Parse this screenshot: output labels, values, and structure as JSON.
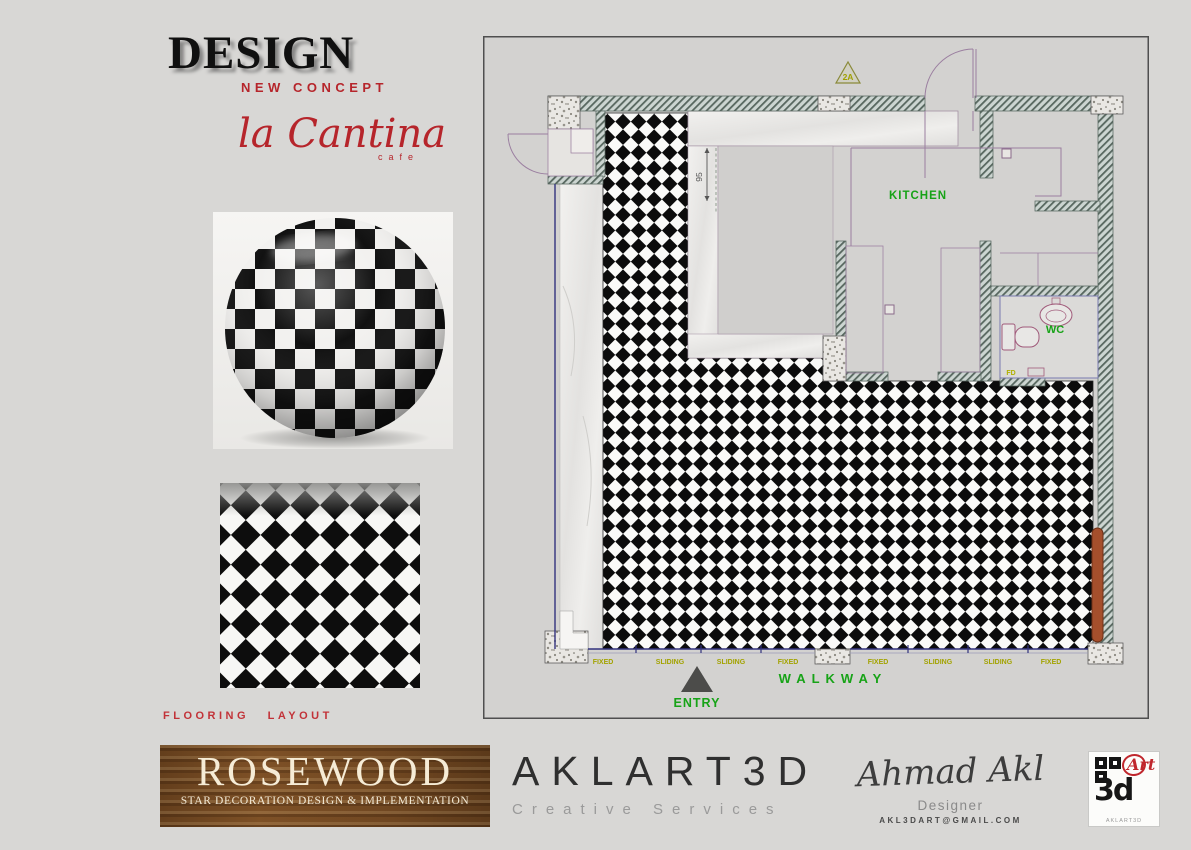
{
  "header": {
    "design_title": "DESIGN",
    "design_subtitle": "NEW CONCEPT",
    "cafe_script": "la Cantina",
    "cafe_word": "cafe"
  },
  "sidebar": {
    "flooring_label": "FLOORING LAYOUT"
  },
  "plan": {
    "kitchen_label": "KITCHEN",
    "wc_label": "WC",
    "floor_drain_label": "FD",
    "walkway_label": "WALKWAY",
    "entry_label": "ENTRY",
    "section_marker": "2A",
    "dimension_95": "95",
    "window_labels": [
      "FIXED",
      "SLIDING",
      "SLIDING",
      "FIXED",
      "FIXED",
      "SLIDING",
      "SLIDING",
      "FIXED"
    ]
  },
  "footer": {
    "rosewood_name": "ROSEWOOD",
    "rosewood_tagline": "STAR DECORATION DESIGN & IMPLEMENTATION",
    "studio_name": "AKLART3D",
    "studio_tagline": "Creative Services",
    "designer_signature": "Ahmad Akl",
    "designer_role": "Designer",
    "designer_email": "AKL3DART@GMAIL.COM",
    "logo_art": "Art",
    "logo_3d": "3d",
    "logo_caption": "AKLART3D"
  },
  "colors": {
    "accent_red": "#b6252b",
    "plan_green": "#17a317",
    "plan_olive": "#a3a300",
    "wood_brown": "#7d5128",
    "bench_brown": "#a54f2c"
  }
}
